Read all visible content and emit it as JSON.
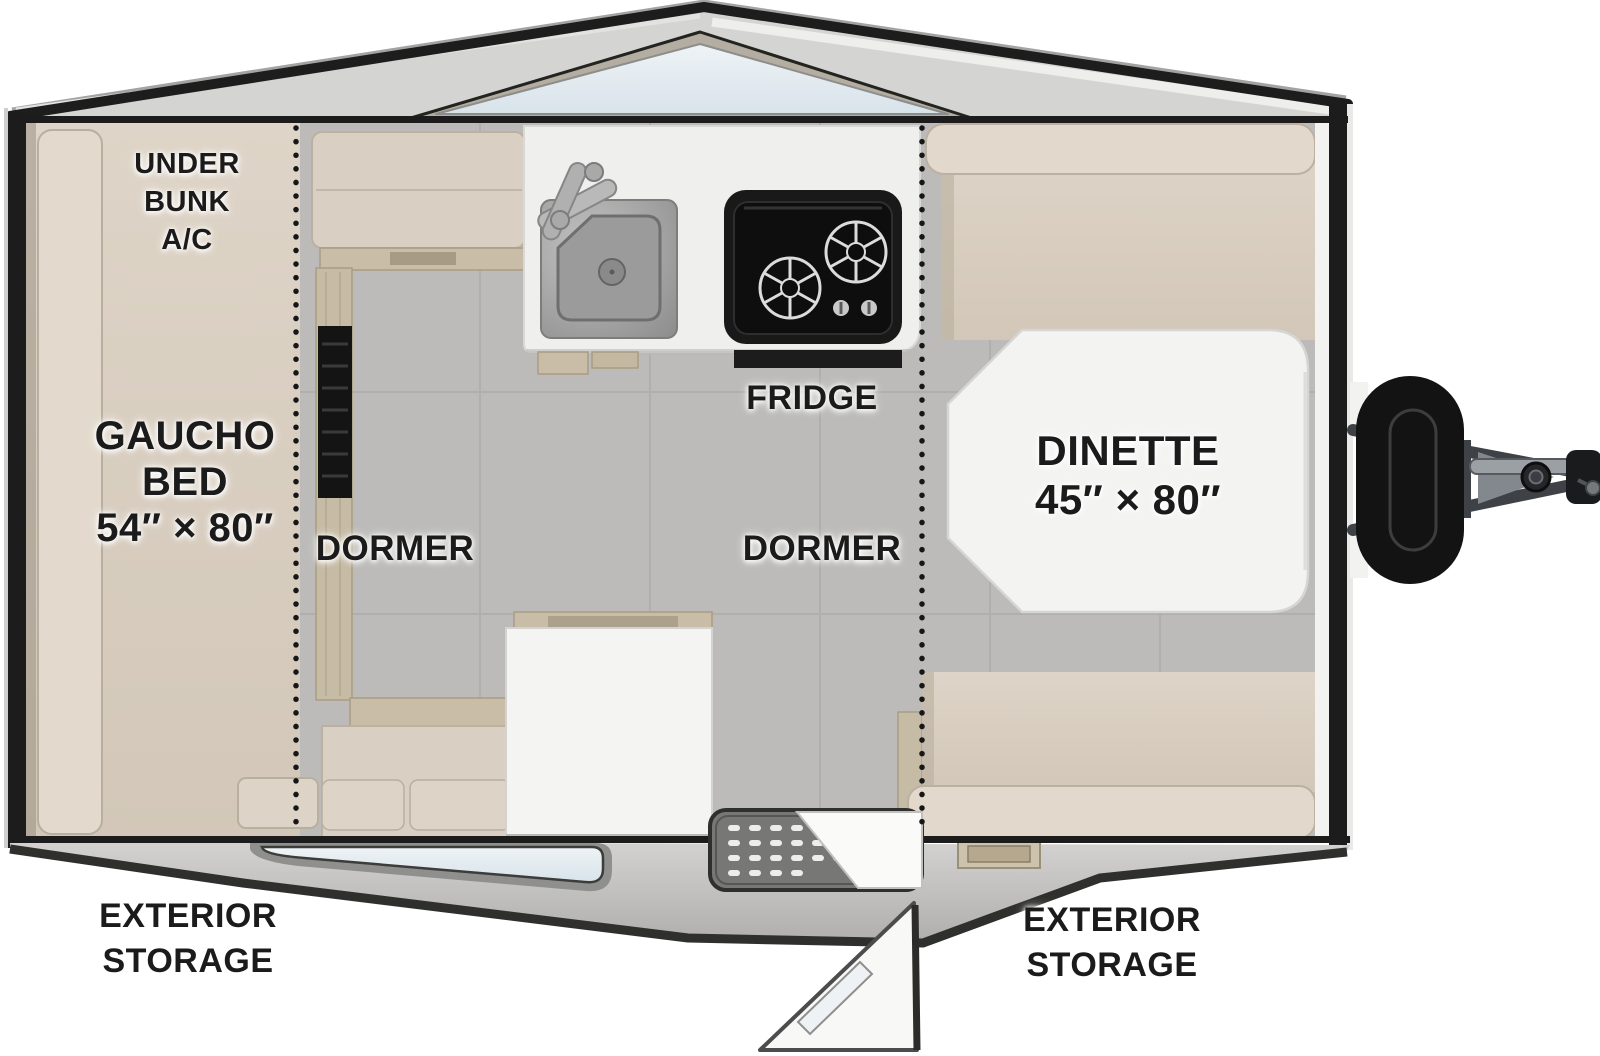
{
  "diagram": {
    "title": "A-frame camper trailer floor plan (top view)",
    "canvas": {
      "width": 1600,
      "height": 1056
    }
  },
  "labels": {
    "under_bunk_ac": {
      "lines": [
        "UNDER",
        "BUNK",
        "A/C"
      ]
    },
    "gaucho_bed": {
      "lines": [
        "GAUCHO",
        "BED",
        "54″ × 80″"
      ]
    },
    "dormer_left": {
      "text": "DORMER"
    },
    "dormer_right": {
      "text": "DORMER"
    },
    "fridge": {
      "text": "FRIDGE"
    },
    "dinette": {
      "lines": [
        "DINETTE",
        "45″ × 80″"
      ]
    },
    "exterior_storage_left": {
      "lines": [
        "EXTERIOR",
        "STORAGE"
      ]
    },
    "exterior_storage_right": {
      "lines": [
        "EXTERIOR",
        "STORAGE"
      ]
    }
  },
  "components": {
    "skylight": "roof window glass panel",
    "gaucho_bed": "bed cushion 54 x 80 in",
    "kitchen_sink": "single bowl sink with faucet",
    "cooktop": "two burner stove",
    "dinette_table": "table 45 x 80 in",
    "dinette_benches": "upholstered bench seats",
    "entry_door": "open entry door with window",
    "step_mat": "perforated entry step",
    "bottom_window": "side wall window",
    "propane_tank": "LP tank with cover",
    "a_frame_tongue": "trailer tongue with jack and coupler",
    "roof_fold_lines": "dotted dormer fold lines"
  },
  "palette": {
    "outline": "#1c1c1c",
    "roof": "#d4d4d2",
    "fabric": "#d9cfc2",
    "fabric_light": "#e2d8cb",
    "wood": "#c9bda8",
    "floor": "#bcbbb9",
    "counter": "#efefee",
    "glass": "#e3ecf1",
    "table": "#f3f3f2",
    "stove": "#171717",
    "skirt": "#c7c6c4",
    "metal": "#9aa0a4",
    "text": "#1b1b1b"
  }
}
